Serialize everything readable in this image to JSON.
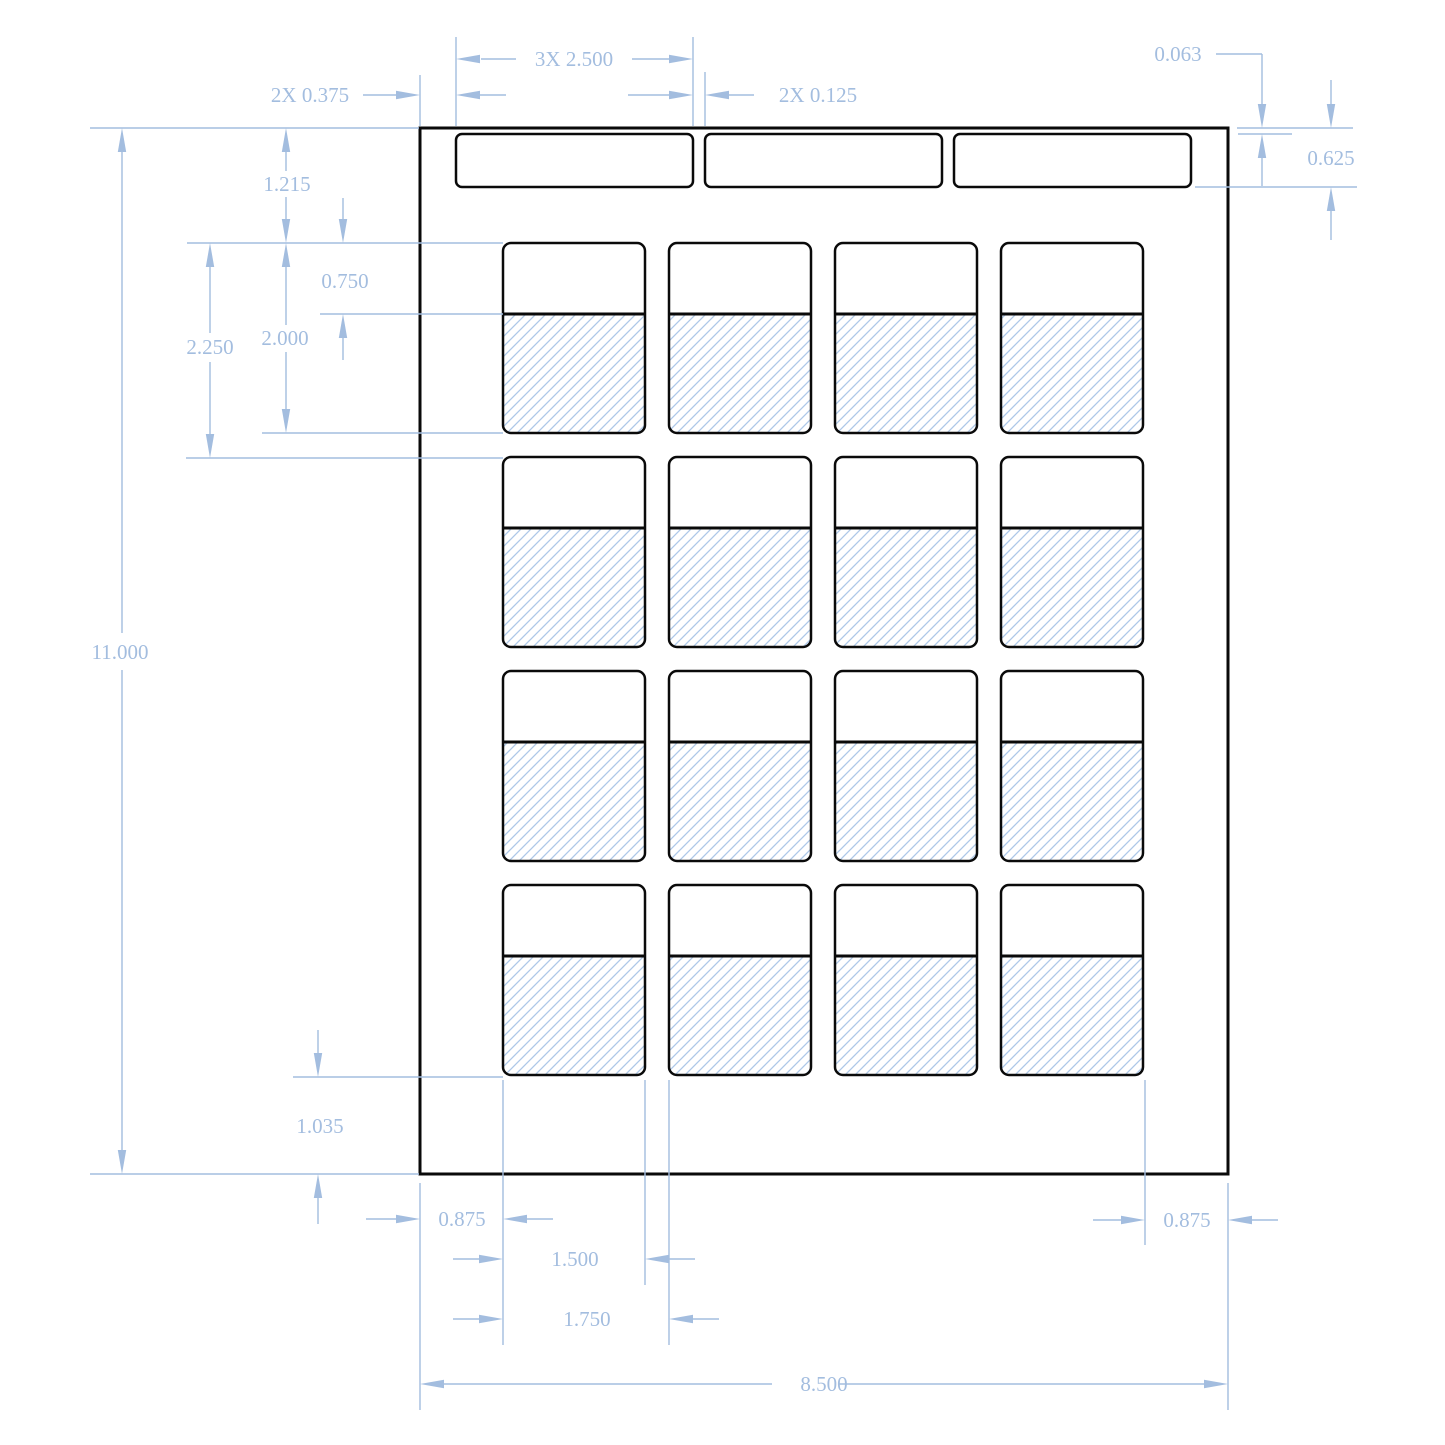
{
  "drawing": {
    "description": "Dieline drawing of 8.5 x 11 label sheet: 3 header strips and 4x4 grid of labels with hatched lower areas",
    "canvas": {
      "w": 1445,
      "h": 1445
    },
    "colors": {
      "background": "#ffffff",
      "outline": "#0a0a0a",
      "dimension": "#a3bddf",
      "hatch": "#adc8e8",
      "label_fill": "#ffffff"
    },
    "sheet": {
      "x": 420,
      "y": 128,
      "w": 808,
      "h": 1046,
      "stroke_w": 3
    },
    "strips": {
      "y": 134,
      "h": 53,
      "w": 237,
      "rx": 6,
      "stroke_w": 2.5,
      "xs": [
        456,
        705,
        954
      ]
    },
    "labels": {
      "w": 142,
      "h": 190,
      "cap_h": 71,
      "rx": 8,
      "stroke_w": 2.5,
      "divider_w": 3,
      "col_xs": [
        503,
        669,
        835,
        1001
      ],
      "row_ys": [
        243,
        457,
        671,
        885
      ]
    },
    "hatch_pattern": {
      "period": 10,
      "stroke_w": 1.3,
      "direction": "forward-slash"
    },
    "dimensions": {
      "font_size": 21,
      "line_w": 1.4,
      "arrow_len": 24,
      "arrow_half_w": 4.2,
      "texts": [
        {
          "t": "3X 2.500",
          "x": 574,
          "y": 59
        },
        {
          "t": "2X 0.375",
          "x": 310,
          "y": 95
        },
        {
          "t": "2X 0.125",
          "x": 818,
          "y": 95
        },
        {
          "t": "0.063",
          "x": 1178,
          "y": 54
        },
        {
          "t": "0.625",
          "x": 1331,
          "y": 158
        },
        {
          "t": "1.215",
          "x": 287,
          "y": 184
        },
        {
          "t": "0.750",
          "x": 345,
          "y": 281
        },
        {
          "t": "2.000",
          "x": 285,
          "y": 338
        },
        {
          "t": "2.250",
          "x": 210,
          "y": 347
        },
        {
          "t": "11.000",
          "x": 120,
          "y": 652
        },
        {
          "t": "1.035",
          "x": 320,
          "y": 1126
        },
        {
          "t": "0.875",
          "x": 462,
          "y": 1219
        },
        {
          "t": "1.500",
          "x": 575,
          "y": 1259
        },
        {
          "t": "1.750",
          "x": 587,
          "y": 1319
        },
        {
          "t": "8.500",
          "x": 824,
          "y": 1384
        },
        {
          "t": "0.875",
          "x": 1187,
          "y": 1220
        }
      ],
      "lines": [
        [
          456,
          37,
          456,
          126
        ],
        [
          693,
          37,
          693,
          126
        ],
        [
          481,
          59,
          516,
          59
        ],
        [
          632,
          59,
          669,
          59
        ],
        [
          363,
          95,
          397,
          95
        ],
        [
          480,
          95,
          506,
          95
        ],
        [
          420,
          75,
          420,
          126
        ],
        [
          628,
          95,
          670,
          95
        ],
        [
          729,
          95,
          754,
          95
        ],
        [
          705,
          72,
          705,
          126
        ],
        [
          1216,
          54,
          1262,
          54
        ],
        [
          1262,
          54,
          1262,
          104
        ],
        [
          1262,
          158,
          1262,
          186
        ],
        [
          1237,
          128,
          1353,
          128
        ],
        [
          1238,
          134,
          1292,
          134
        ],
        [
          1331,
          80,
          1331,
          104
        ],
        [
          1331,
          211,
          1331,
          240
        ],
        [
          1195,
          187,
          1357,
          187
        ],
        [
          90,
          128,
          419,
          128
        ],
        [
          122,
          152,
          122,
          633
        ],
        [
          122,
          670,
          122,
          1150
        ],
        [
          90,
          1174,
          419,
          1174
        ],
        [
          286,
          152,
          286,
          171
        ],
        [
          286,
          197,
          286,
          219
        ],
        [
          187,
          243,
          503,
          243
        ],
        [
          343,
          198,
          343,
          219
        ],
        [
          343,
          338,
          343,
          360
        ],
        [
          320,
          314,
          503,
          314
        ],
        [
          286,
          267,
          286,
          325
        ],
        [
          286,
          352,
          286,
          409
        ],
        [
          262,
          433,
          503,
          433
        ],
        [
          210,
          267,
          210,
          333
        ],
        [
          210,
          362,
          210,
          434
        ],
        [
          186,
          458,
          503,
          458
        ],
        [
          318,
          1030,
          318,
          1053
        ],
        [
          318,
          1198,
          318,
          1224
        ],
        [
          293,
          1077,
          503,
          1077
        ],
        [
          420,
          1183,
          420,
          1410
        ],
        [
          503,
          1080,
          503,
          1345
        ],
        [
          366,
          1219,
          396,
          1219
        ],
        [
          527,
          1219,
          553,
          1219
        ],
        [
          453,
          1259,
          479,
          1259
        ],
        [
          669,
          1259,
          695,
          1259
        ],
        [
          645,
          1080,
          645,
          1285
        ],
        [
          453,
          1319,
          479,
          1319
        ],
        [
          693,
          1319,
          719,
          1319
        ],
        [
          669,
          1080,
          669,
          1345
        ],
        [
          444,
          1384,
          772,
          1384
        ],
        [
          838,
          1384,
          1204,
          1384
        ],
        [
          1228,
          1183,
          1228,
          1410
        ],
        [
          1093,
          1220,
          1121,
          1220
        ],
        [
          1252,
          1220,
          1278,
          1220
        ],
        [
          1145,
          1080,
          1145,
          1245
        ]
      ],
      "arrows": [
        [
          456,
          59,
          "left"
        ],
        [
          693,
          59,
          "right"
        ],
        [
          420,
          95,
          "right"
        ],
        [
          456,
          95,
          "left"
        ],
        [
          693,
          95,
          "right"
        ],
        [
          705,
          95,
          "left"
        ],
        [
          1262,
          128,
          "down"
        ],
        [
          1262,
          134,
          "up"
        ],
        [
          1331,
          128,
          "down"
        ],
        [
          1331,
          187,
          "up"
        ],
        [
          122,
          128,
          "up"
        ],
        [
          122,
          1174,
          "down"
        ],
        [
          286,
          128,
          "up"
        ],
        [
          286,
          243,
          "down"
        ],
        [
          343,
          243,
          "down"
        ],
        [
          343,
          314,
          "up"
        ],
        [
          286,
          243,
          "up"
        ],
        [
          286,
          433,
          "down"
        ],
        [
          210,
          243,
          "up"
        ],
        [
          210,
          458,
          "down"
        ],
        [
          318,
          1077,
          "down"
        ],
        [
          318,
          1174,
          "up"
        ],
        [
          420,
          1219,
          "right"
        ],
        [
          503,
          1219,
          "left"
        ],
        [
          503,
          1259,
          "right"
        ],
        [
          645,
          1259,
          "left"
        ],
        [
          503,
          1319,
          "right"
        ],
        [
          669,
          1319,
          "left"
        ],
        [
          420,
          1384,
          "left"
        ],
        [
          1228,
          1384,
          "right"
        ],
        [
          1145,
          1220,
          "right"
        ],
        [
          1228,
          1220,
          "left"
        ]
      ]
    }
  }
}
